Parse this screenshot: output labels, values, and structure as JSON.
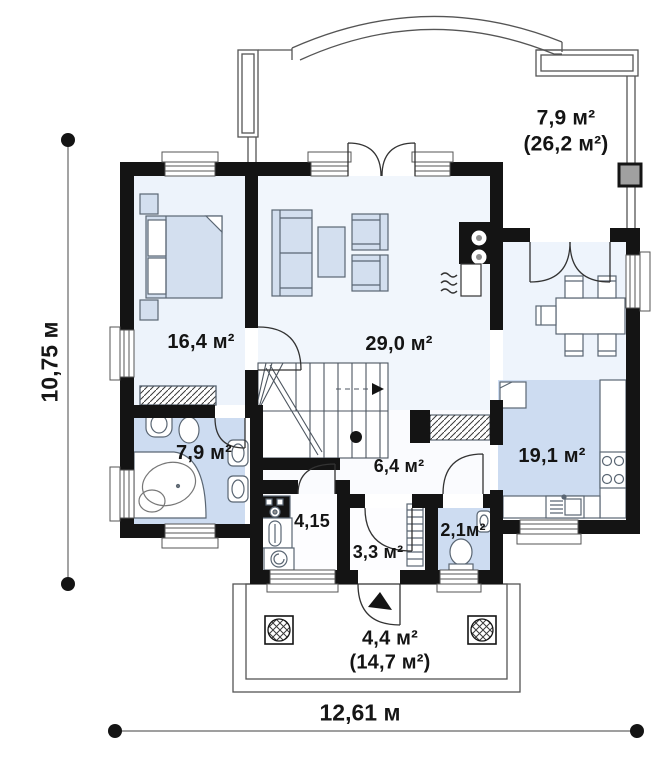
{
  "plan": {
    "title": "first-floor-plan",
    "rooms": [
      {
        "id": "terrace",
        "area_label": "7,9 м²",
        "total_label": "(26,2 м²)"
      },
      {
        "id": "bedroom",
        "area_label": "16,4 м²"
      },
      {
        "id": "living-room",
        "area_label": "29,0 м²"
      },
      {
        "id": "bathroom",
        "area_label": "7,9 м²"
      },
      {
        "id": "hall",
        "area_label": "6,4 м²"
      },
      {
        "id": "utility",
        "area_label": "4,15"
      },
      {
        "id": "vestibule",
        "area_label": "3,3 м²"
      },
      {
        "id": "wc",
        "area_label": "2,1м²"
      },
      {
        "id": "kitchen",
        "area_label": "19,1 м²"
      },
      {
        "id": "porch",
        "area_label": "4,4 м²",
        "total_label": "(14,7 м²)"
      }
    ],
    "dimensions": {
      "height": "10,75 м",
      "width": "12,61 м"
    },
    "colors": {
      "wall": "#141414",
      "floor_light": "#edf3fb",
      "floor_blue": "#cddcf1",
      "furniture_fill": "#d3dfef",
      "post_gray": "#a0a0a0",
      "line": "#4d5660"
    }
  }
}
